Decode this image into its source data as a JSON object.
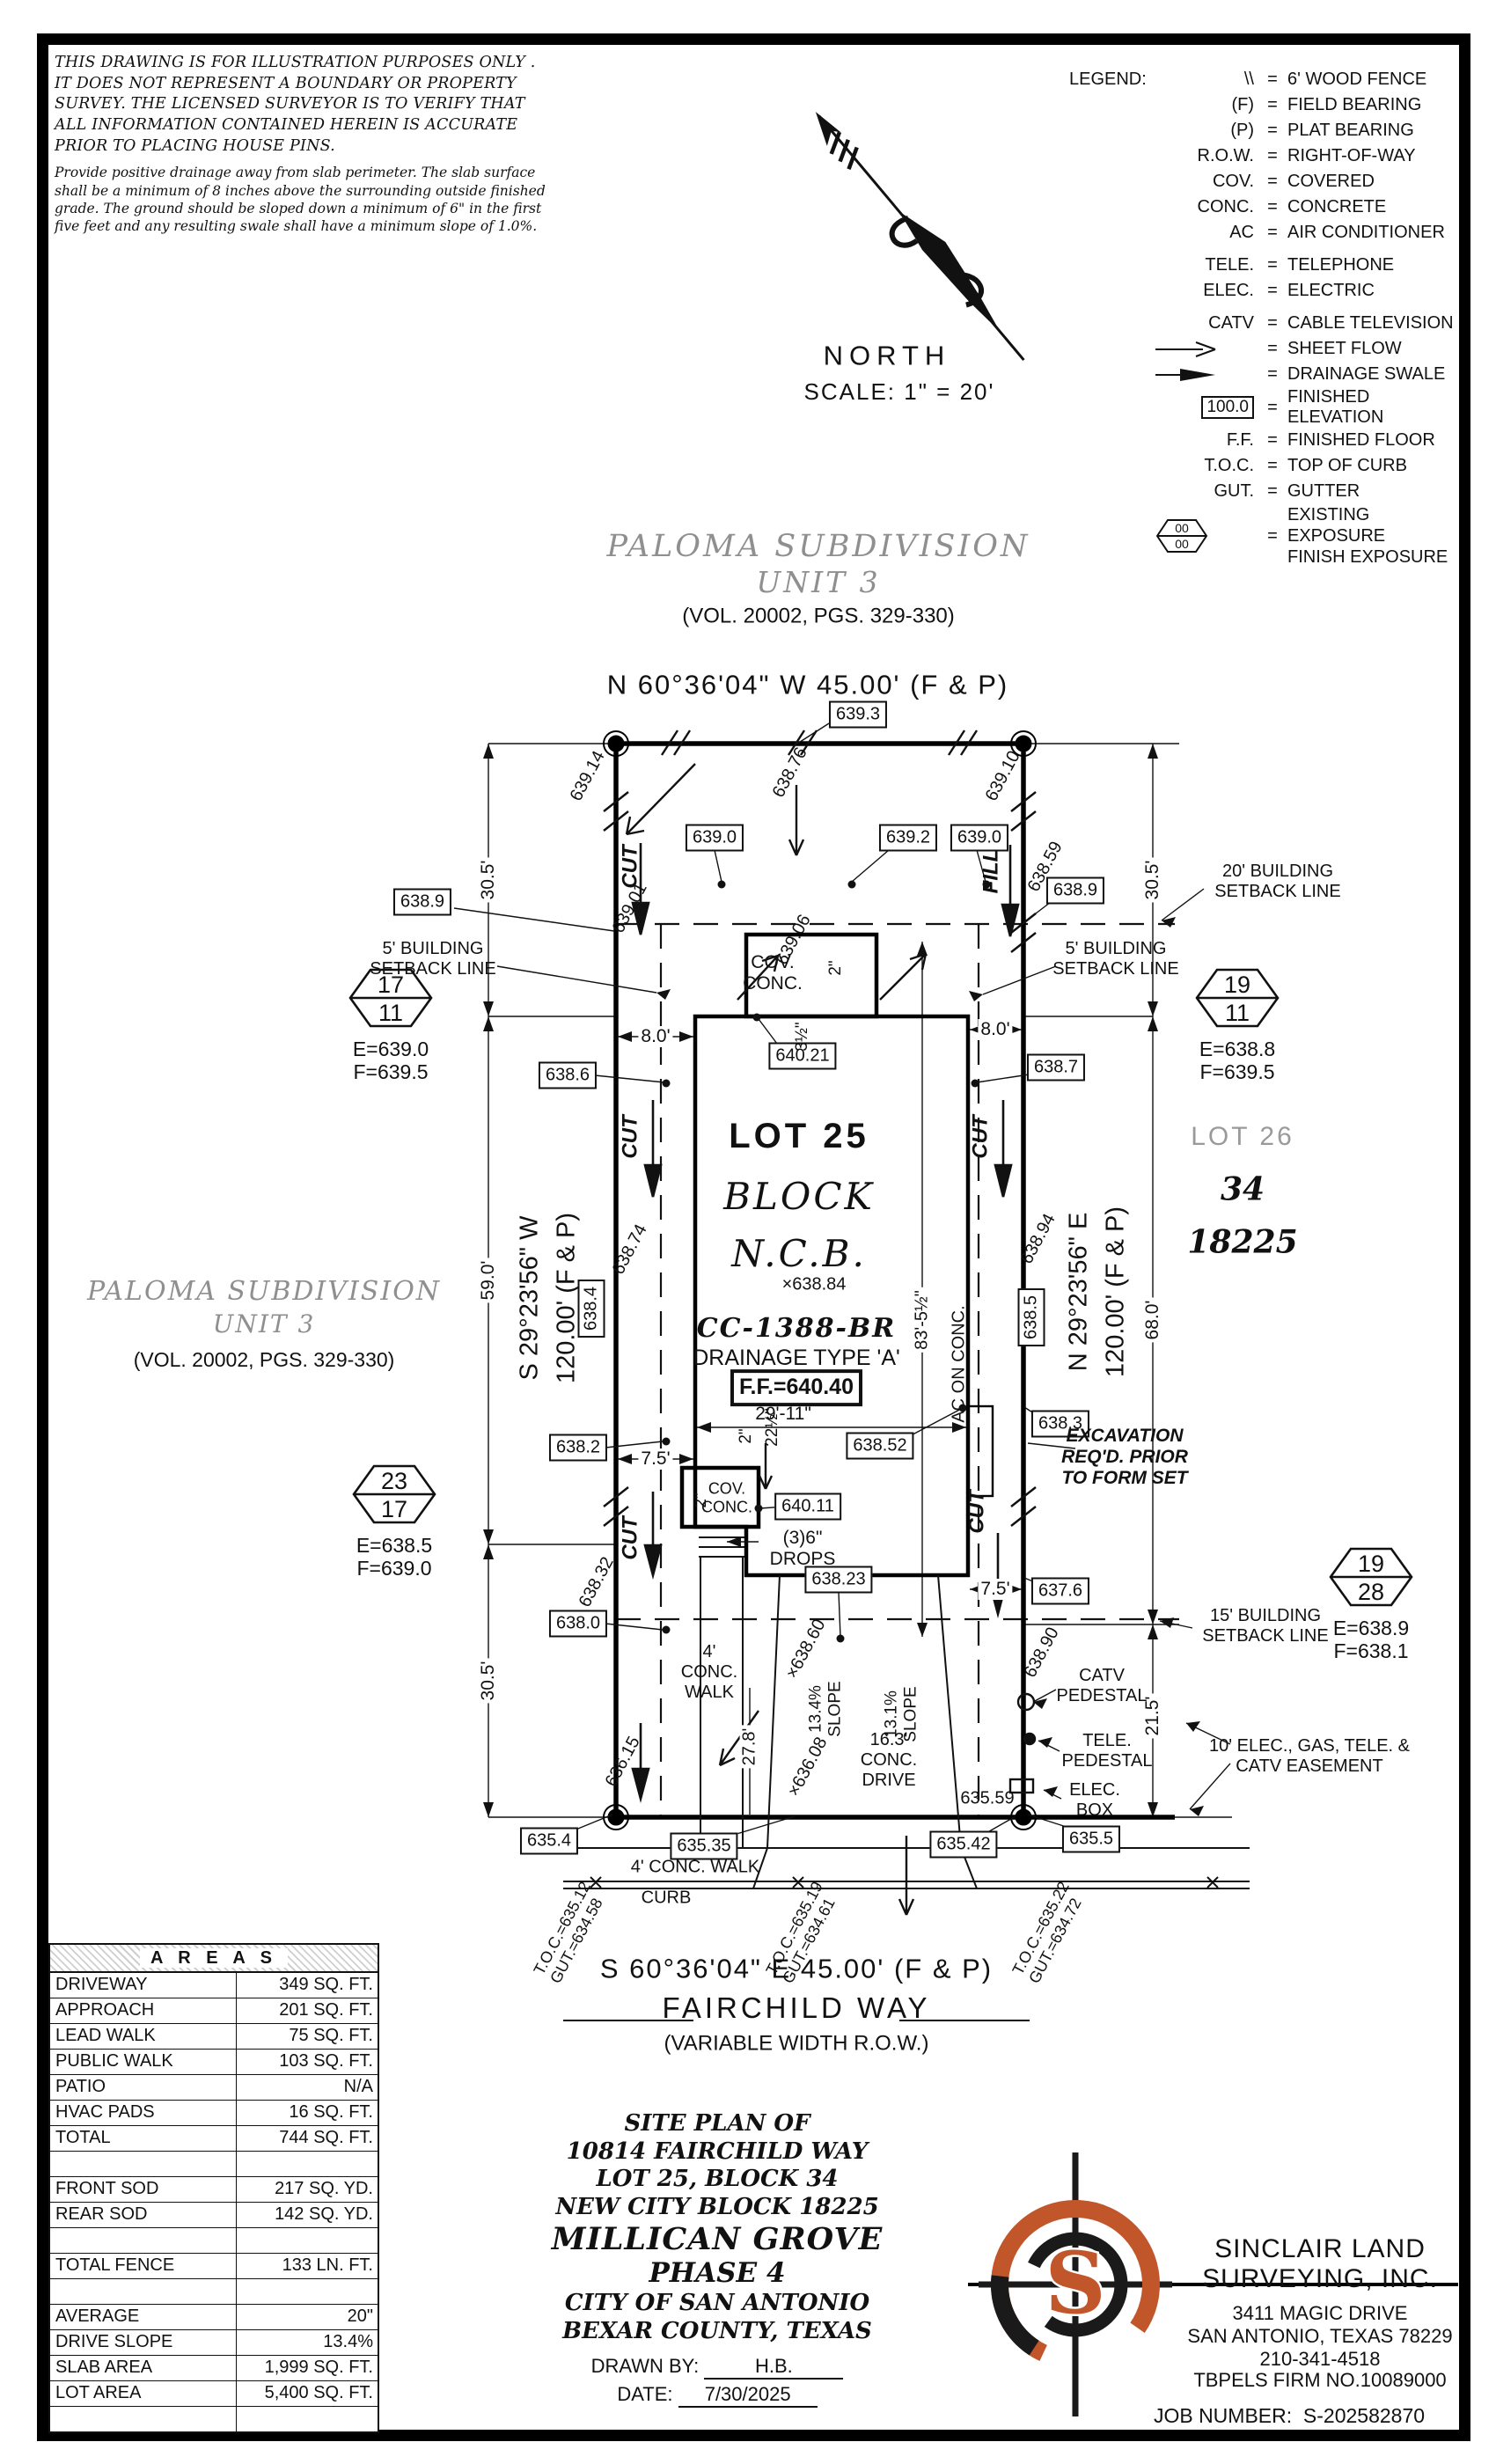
{
  "colors": {
    "accent": "#c2562b",
    "muted_gray": "#8f8f8f"
  },
  "disclaimer": {
    "para1": "THIS DRAWING IS FOR ILLUSTRATION PURPOSES ONLY . IT DOES NOT REPRESENT A BOUNDARY OR PROPERTY SURVEY. THE LICENSED SURVEYOR IS TO VERIFY THAT ALL INFORMATION CONTAINED HEREIN IS ACCURATE PRIOR TO PLACING HOUSE PINS.",
    "para2": "Provide positive drainage away from slab perimeter. The slab surface shall be a minimum of 8 inches above the surrounding outside finished grade. The ground should be sloped down a minimum of 6\" in the first five feet and any resulting swale shall have a minimum slope of 1.0%."
  },
  "north": {
    "label": "NORTH",
    "scale": "SCALE: 1\" = 20'"
  },
  "legend": {
    "title": "LEGEND:",
    "eq": "=",
    "items": [
      {
        "abbr": "\\\\",
        "label": "6' WOOD FENCE"
      },
      {
        "abbr": "(F)",
        "label": "FIELD BEARING"
      },
      {
        "abbr": "(P)",
        "label": "PLAT BEARING"
      },
      {
        "abbr": "R.O.W.",
        "label": "RIGHT-OF-WAY"
      },
      {
        "abbr": "COV.",
        "label": "COVERED"
      },
      {
        "abbr": "CONC.",
        "label": "CONCRETE"
      },
      {
        "abbr": "AC",
        "label": "AIR CONDITIONER"
      },
      {
        "abbr": "TELE.",
        "label": "TELEPHONE"
      },
      {
        "abbr": "ELEC.",
        "label": "ELECTRIC"
      },
      {
        "abbr": "CATV",
        "label": "CABLE TELEVISION"
      },
      {
        "abbr": "",
        "label": "SHEET FLOW"
      },
      {
        "abbr": "",
        "label": "DRAINAGE SWALE"
      },
      {
        "abbr": "100.0",
        "label": "FINISHED ELEVATION"
      },
      {
        "abbr": "F.F.",
        "label": "FINISHED FLOOR"
      },
      {
        "abbr": "T.O.C.",
        "label": "TOP OF CURB"
      },
      {
        "abbr": "GUT.",
        "label": "GUTTER"
      },
      {
        "abbr": "00",
        "abbr2": "00",
        "label": "EXISTING EXPOSURE",
        "label2": "FINISH EXPOSURE"
      }
    ]
  },
  "subdivision_top": {
    "line1": "PALOMA SUBDIVISION",
    "line2": "UNIT 3",
    "line3": "(VOL. 20002, PGS. 329-330)"
  },
  "subdivision_left": {
    "line1": "PALOMA SUBDIVISION",
    "line2": "UNIT 3",
    "line3": "(VOL. 20002, PGS. 329-330)"
  },
  "bearings": {
    "north": "N 60°36'04\" W 45.00' (F & P)",
    "south": "S 60°36'04\" E 45.00' (F & P)",
    "west_line1": "S 29°23'56\" W",
    "west_line2": "120.00' (F & P)",
    "east_line1": "N 29°23'56\" E",
    "east_line2": "120.00' (F & P)"
  },
  "street": {
    "name": "FAIRCHILD WAY",
    "row_note": "(VARIABLE WIDTH R.O.W.)"
  },
  "lot": {
    "name": "LOT 25",
    "block_word": "BLOCK",
    "ncb_word": "N.C.B.",
    "spot": "×638.84",
    "plan_code": "CC-1388-BR",
    "drainage": "DRAINAGE TYPE 'A'",
    "finished_floor": "F.F.=640.40",
    "width_dim": "29'-11\"",
    "depth_dim": "83'-5½\"",
    "ac_pad": "AC ON CONC."
  },
  "adjacent": {
    "lot": "LOT 26",
    "block": "34",
    "ncb": "18225"
  },
  "corner_markers": [
    {
      "top": "17",
      "bottom": "11",
      "existing": "E=639.0",
      "finish": "F=639.5"
    },
    {
      "top": "19",
      "bottom": "11",
      "existing": "E=638.8",
      "finish": "F=639.5"
    },
    {
      "top": "23",
      "bottom": "17",
      "existing": "E=638.5",
      "finish": "F=639.0"
    },
    {
      "top": "19",
      "bottom": "28",
      "existing": "E=638.9",
      "finish": "F=638.1"
    }
  ],
  "elevations": {
    "e0": "639.3",
    "e1": "639.0",
    "e2": "639.2",
    "e3": "639.0",
    "e4": "638.9",
    "e5": "638.9",
    "e6": "638.6",
    "e7": "638.7",
    "e8": "640.21",
    "e9": "638.3",
    "e10": "638.2",
    "e11": "638.52",
    "e12": "640.11",
    "e13": "638.23",
    "e14": "638.0",
    "e15": "637.6",
    "e16": "635.4",
    "e17": "635.35",
    "e18": "635.42",
    "e19": "635.5",
    "e20": "638.4",
    "e21": "638.5"
  },
  "spots": {
    "s0": "639.14",
    "s1": "638.76",
    "s2": "639.10",
    "s3": "638.59",
    "s4": "639.01",
    "s5": "639.06",
    "s6": "638.74",
    "s7": "638.94",
    "s8": "638.32",
    "s9": "×638.60",
    "s10": "638.90",
    "s11": "636.15",
    "s12": "×636.08",
    "s13": "635.59"
  },
  "dims": {
    "left_top": "30.5'",
    "left_mid": "59.0'",
    "left_bot": "30.5'",
    "right_top": "30.5'",
    "right_mid": "68.0'",
    "right_bot": "21.5'",
    "rear_left": "8.0'",
    "rear_right": "8.0'",
    "side_left": "7.5'",
    "side_right": "7.5'",
    "drive_len": "27.8'",
    "s225": "22½\"",
    "s35": "3½\"",
    "s2a": "2\"",
    "s2b": "2\"",
    "s2c": "2\""
  },
  "setbacks": {
    "five": "5' BUILDING SETBACK LINE",
    "fifteen": "15' BUILDING SETBACK LINE",
    "twenty": "20' BUILDING SETBACK LINE"
  },
  "cutfill": {
    "cut": "CUT",
    "fill": "FILL"
  },
  "annotations": {
    "excavation": "EXCAVATION REQ'D. PRIOR TO FORM SET",
    "cov_conc": "COV. CONC.",
    "cov_conc2": "COV. CONC.",
    "drops": "(3)6\" DROPS",
    "walk_rear": "4' CONC. WALK",
    "walk_front": "4' CONC. WALK",
    "curb": "CURB",
    "drive": "16.3' CONC. DRIVE",
    "slope_a": "13.4% SLOPE",
    "slope_b": "13.1% SLOPE",
    "catv": "CATV PEDESTAL",
    "tele": "TELE. PEDESTAL",
    "elec": "ELEC. BOX",
    "easement": "10' ELEC., GAS, TELE. & CATV EASEMENT"
  },
  "toc": [
    {
      "toc": "T.O.C.=635.12",
      "gut": "GUT.=634.58"
    },
    {
      "toc": "T.O.C.=635.19",
      "gut": "GUT.=634.61"
    },
    {
      "toc": "T.O.C.=635.22",
      "gut": "GUT.=634.72"
    }
  ],
  "areas_table": {
    "title": "A R E A S",
    "rows": [
      {
        "label": "DRIVEWAY",
        "value": "349 SQ. FT."
      },
      {
        "label": "APPROACH",
        "value": "201 SQ. FT."
      },
      {
        "label": "LEAD WALK",
        "value": "75 SQ. FT."
      },
      {
        "label": "PUBLIC WALK",
        "value": "103 SQ. FT."
      },
      {
        "label": "PATIO",
        "value": "N/A"
      },
      {
        "label": "HVAC PADS",
        "value": "16 SQ. FT."
      },
      {
        "label": "TOTAL",
        "value": "744 SQ. FT."
      },
      {
        "label": "",
        "value": ""
      },
      {
        "label": "FRONT SOD",
        "value": "217 SQ. YD."
      },
      {
        "label": "REAR SOD",
        "value": "142 SQ. YD."
      },
      {
        "label": "",
        "value": ""
      },
      {
        "label": "TOTAL FENCE",
        "value": "133 LN. FT."
      },
      {
        "label": "",
        "value": ""
      },
      {
        "label": "AVERAGE EXPOSURE",
        "value": "20\""
      },
      {
        "label": "DRIVE SLOPE",
        "value": "13.4%"
      },
      {
        "label": "SLAB AREA",
        "value": "1,999 SQ. FT."
      },
      {
        "label": "LOT AREA",
        "value": "5,400 SQ. FT."
      },
      {
        "label": "",
        "value": ""
      }
    ]
  },
  "title_block": {
    "l1": "SITE PLAN OF",
    "l2": "10814 FAIRCHILD WAY",
    "l3": "LOT 25, BLOCK 34",
    "l4": "NEW CITY BLOCK 18225",
    "l5": "MILLICAN GROVE",
    "l6": "PHASE 4",
    "l7": "CITY OF SAN ANTONIO",
    "l8": "BEXAR COUNTY, TEXAS",
    "drawn_by_label": "DRAWN BY:",
    "drawn_by": "H.B.",
    "date_label": "DATE:",
    "date": "7/30/2025"
  },
  "company": {
    "name1": "SINCLAIR LAND",
    "name2": "SURVEYING, INC.",
    "addr1": "3411 MAGIC DRIVE",
    "addr2": "SAN ANTONIO, TEXAS 78229",
    "phone": "210-341-4518",
    "firm": "TBPELS FIRM NO.10089000",
    "job_label": "JOB NUMBER:",
    "job": "S-202582870"
  }
}
